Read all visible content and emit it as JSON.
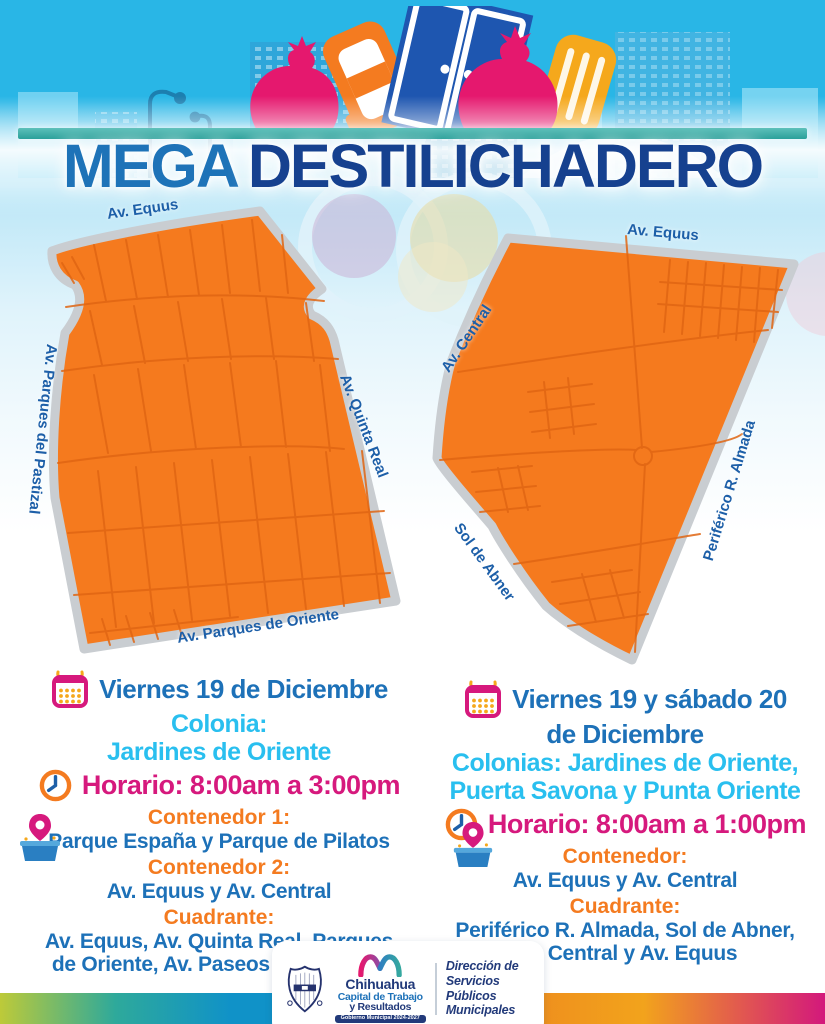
{
  "title": {
    "word1": "MEGA",
    "word2": "DESTILICHADERO"
  },
  "maps": {
    "left": {
      "streets": {
        "top": "Av. Equus",
        "left": "Av. Parques del Pastizal",
        "right": "Av. Quinta Real",
        "bottom": "Av. Parques de Oriente"
      }
    },
    "right": {
      "streets": {
        "top": "Av. Equus",
        "left": "Av. Central",
        "right": "Periférico R. Almada",
        "bottom_left": "Sol de Abner"
      }
    }
  },
  "events": {
    "left": {
      "date": "Viernes 19 de Diciembre",
      "colonia_label": "Colonia:",
      "colonia": "Jardines de Oriente",
      "horario": "Horario: 8:00am a 3:00pm",
      "contenedor1_label": "Contenedor 1:",
      "contenedor1": "Parque España y Parque de Pilatos",
      "contenedor2_label": "Contenedor 2:",
      "contenedor2": "Av. Equus y Av. Central",
      "cuadrante_label": "Cuadrante:",
      "cuadrante_line1": "Av. Equus, Av. Quinta Real, Parques",
      "cuadrante_line2": "de Oriente, Av. Paseos del Pastizal"
    },
    "right": {
      "date_line1": "Viernes 19 y sábado 20",
      "date_line2": "de Diciembre",
      "colonias_line1": "Colonias: Jardines de Oriente,",
      "colonias_line2": "Puerta Savona y Punta Oriente",
      "horario": "Horario: 8:00am a 1:00pm",
      "contenedor_label": "Contenedor:",
      "contenedor": "Av. Equus y Av. Central",
      "cuadrante_label": "Cuadrante:",
      "cuadrante_line1": "Periférico R. Almada, Sol de Abner,",
      "cuadrante_line2": "Av. Central y Av. Equus"
    }
  },
  "footer": {
    "logo_title": "Chihuahua",
    "logo_sub1": "Capital de Trabajo",
    "logo_sub2": "y Resultados",
    "logo_banner": "Gobierno Municipal 2024-2027",
    "dept_line1": "Dirección de",
    "dept_line2": "Servicios Públicos",
    "dept_line3": "Municipales"
  },
  "icons": {
    "date": "calendar-icon",
    "time": "clock-icon",
    "location": "pin-container-icon"
  },
  "colors": {
    "sky": "#29b6e6",
    "title_mega": "#1e73b8",
    "title_dest": "#16418f",
    "teal_bar": "#2aa09a",
    "map_orange": "#f57a1e",
    "map_border_gray": "#c9cdd1",
    "cyan_text": "#29bfef",
    "magenta": "#d6197d",
    "orange_label": "#f47b20",
    "blue_text": "#1d71b8",
    "navy_footer": "#223a7a"
  }
}
